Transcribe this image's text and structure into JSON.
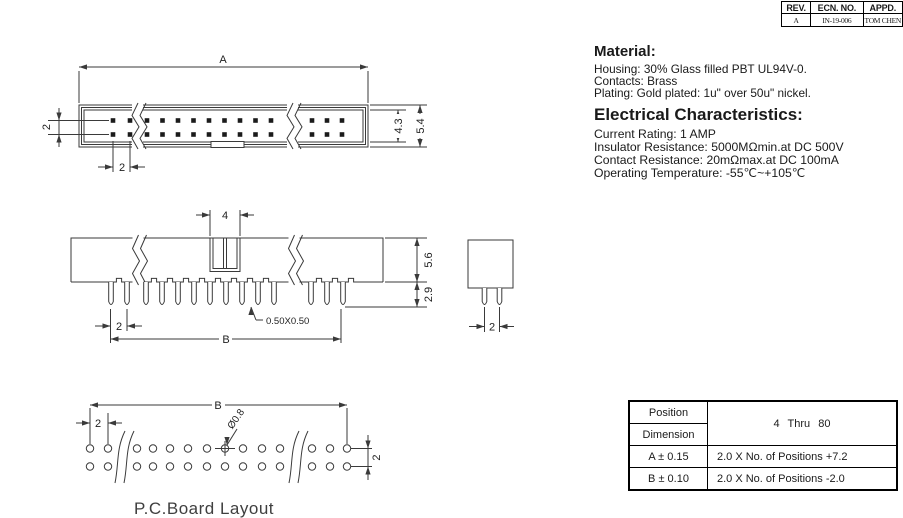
{
  "rev_table": {
    "headers": [
      "REV.",
      "ECN. NO.",
      "APPD."
    ],
    "row": [
      "A",
      "IN-19-006",
      "TOM CHEN"
    ]
  },
  "notes": {
    "material_heading": "Material:",
    "material_lines": [
      "Housing: 30% Glass filled PBT UL94V-0.",
      "Contacts: Brass",
      "Plating: Gold plated: 1u\" over 50u\" nickel."
    ],
    "electrical_heading": "Electrical Characteristics:",
    "electrical_lines": [
      "Current Rating: 1 AMP",
      "Insulator Resistance: 5000MΩmin.at DC 500V",
      "Contact Resistance: 20mΩmax.at DC 100mA",
      "Operating Temperature: -55℃~+105℃"
    ]
  },
  "spec_table": {
    "position_label": "Position",
    "dimension_label": "Dimension",
    "range_label": "4 Thru 80",
    "rows": [
      {
        "dim": "A ± 0.15",
        "formula": "2.0 X No. of Positions +7.2"
      },
      {
        "dim": "B ± 0.10",
        "formula": "2.0 X No. of Positions -2.0"
      }
    ]
  },
  "drawings": {
    "top_view": {
      "dim_a": "A",
      "dim_row_pitch": "2",
      "dim_col_pitch": "2",
      "dim_inner_height": "4.3",
      "dim_outer_height": "5.4"
    },
    "front_view": {
      "dim_key_width": "4",
      "dim_body_height": "5.6",
      "dim_pin_length": "2.9",
      "dim_pin_pitch": "2",
      "dim_span": "B",
      "dim_pin_square": "0.50X0.50"
    },
    "side_view": {
      "dim_pin_pitch": "2"
    },
    "pcb_layout": {
      "dim_span": "B",
      "dim_hole": "Ø0.8",
      "dim_pitch": "2",
      "dim_row_pitch": "2",
      "caption": "P.C.Board Layout"
    }
  }
}
